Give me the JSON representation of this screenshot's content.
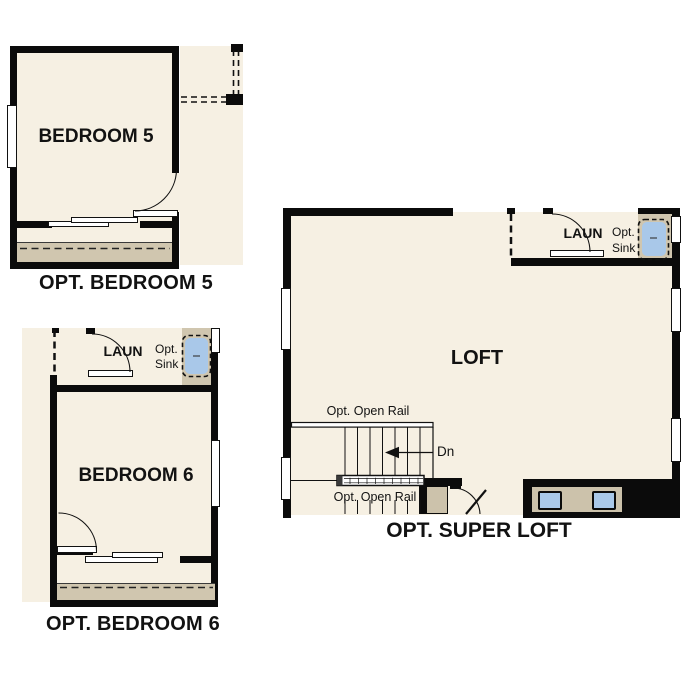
{
  "page": {
    "background": "#ffffff"
  },
  "colors": {
    "background": "#ffffff",
    "wall": "#0b0b0b",
    "floor": "#f6f0e3",
    "closet": "#d0c6af",
    "counter": "#ccc2ab",
    "sink": "#a9c8e9",
    "text": "#121212"
  },
  "plans": {
    "bedroom5": {
      "caption": "OPT. BEDROOM 5",
      "room_label": "BEDROOM 5"
    },
    "bedroom6": {
      "caption": "OPT. BEDROOM 6",
      "room_label": "BEDROOM 6",
      "laundry_label": "LAUN",
      "opt_sink_line1": "Opt.",
      "opt_sink_line2": "Sink"
    },
    "super_loft": {
      "caption": "OPT. SUPER LOFT",
      "room_label": "LOFT",
      "laundry_label": "LAUN",
      "opt_sink_line1": "Opt.",
      "opt_sink_line2": "Sink",
      "open_rail_top_label": "Opt. Open Rail",
      "open_rail_bottom_label": "Opt. Open Rail",
      "down_label": "Dn"
    }
  }
}
